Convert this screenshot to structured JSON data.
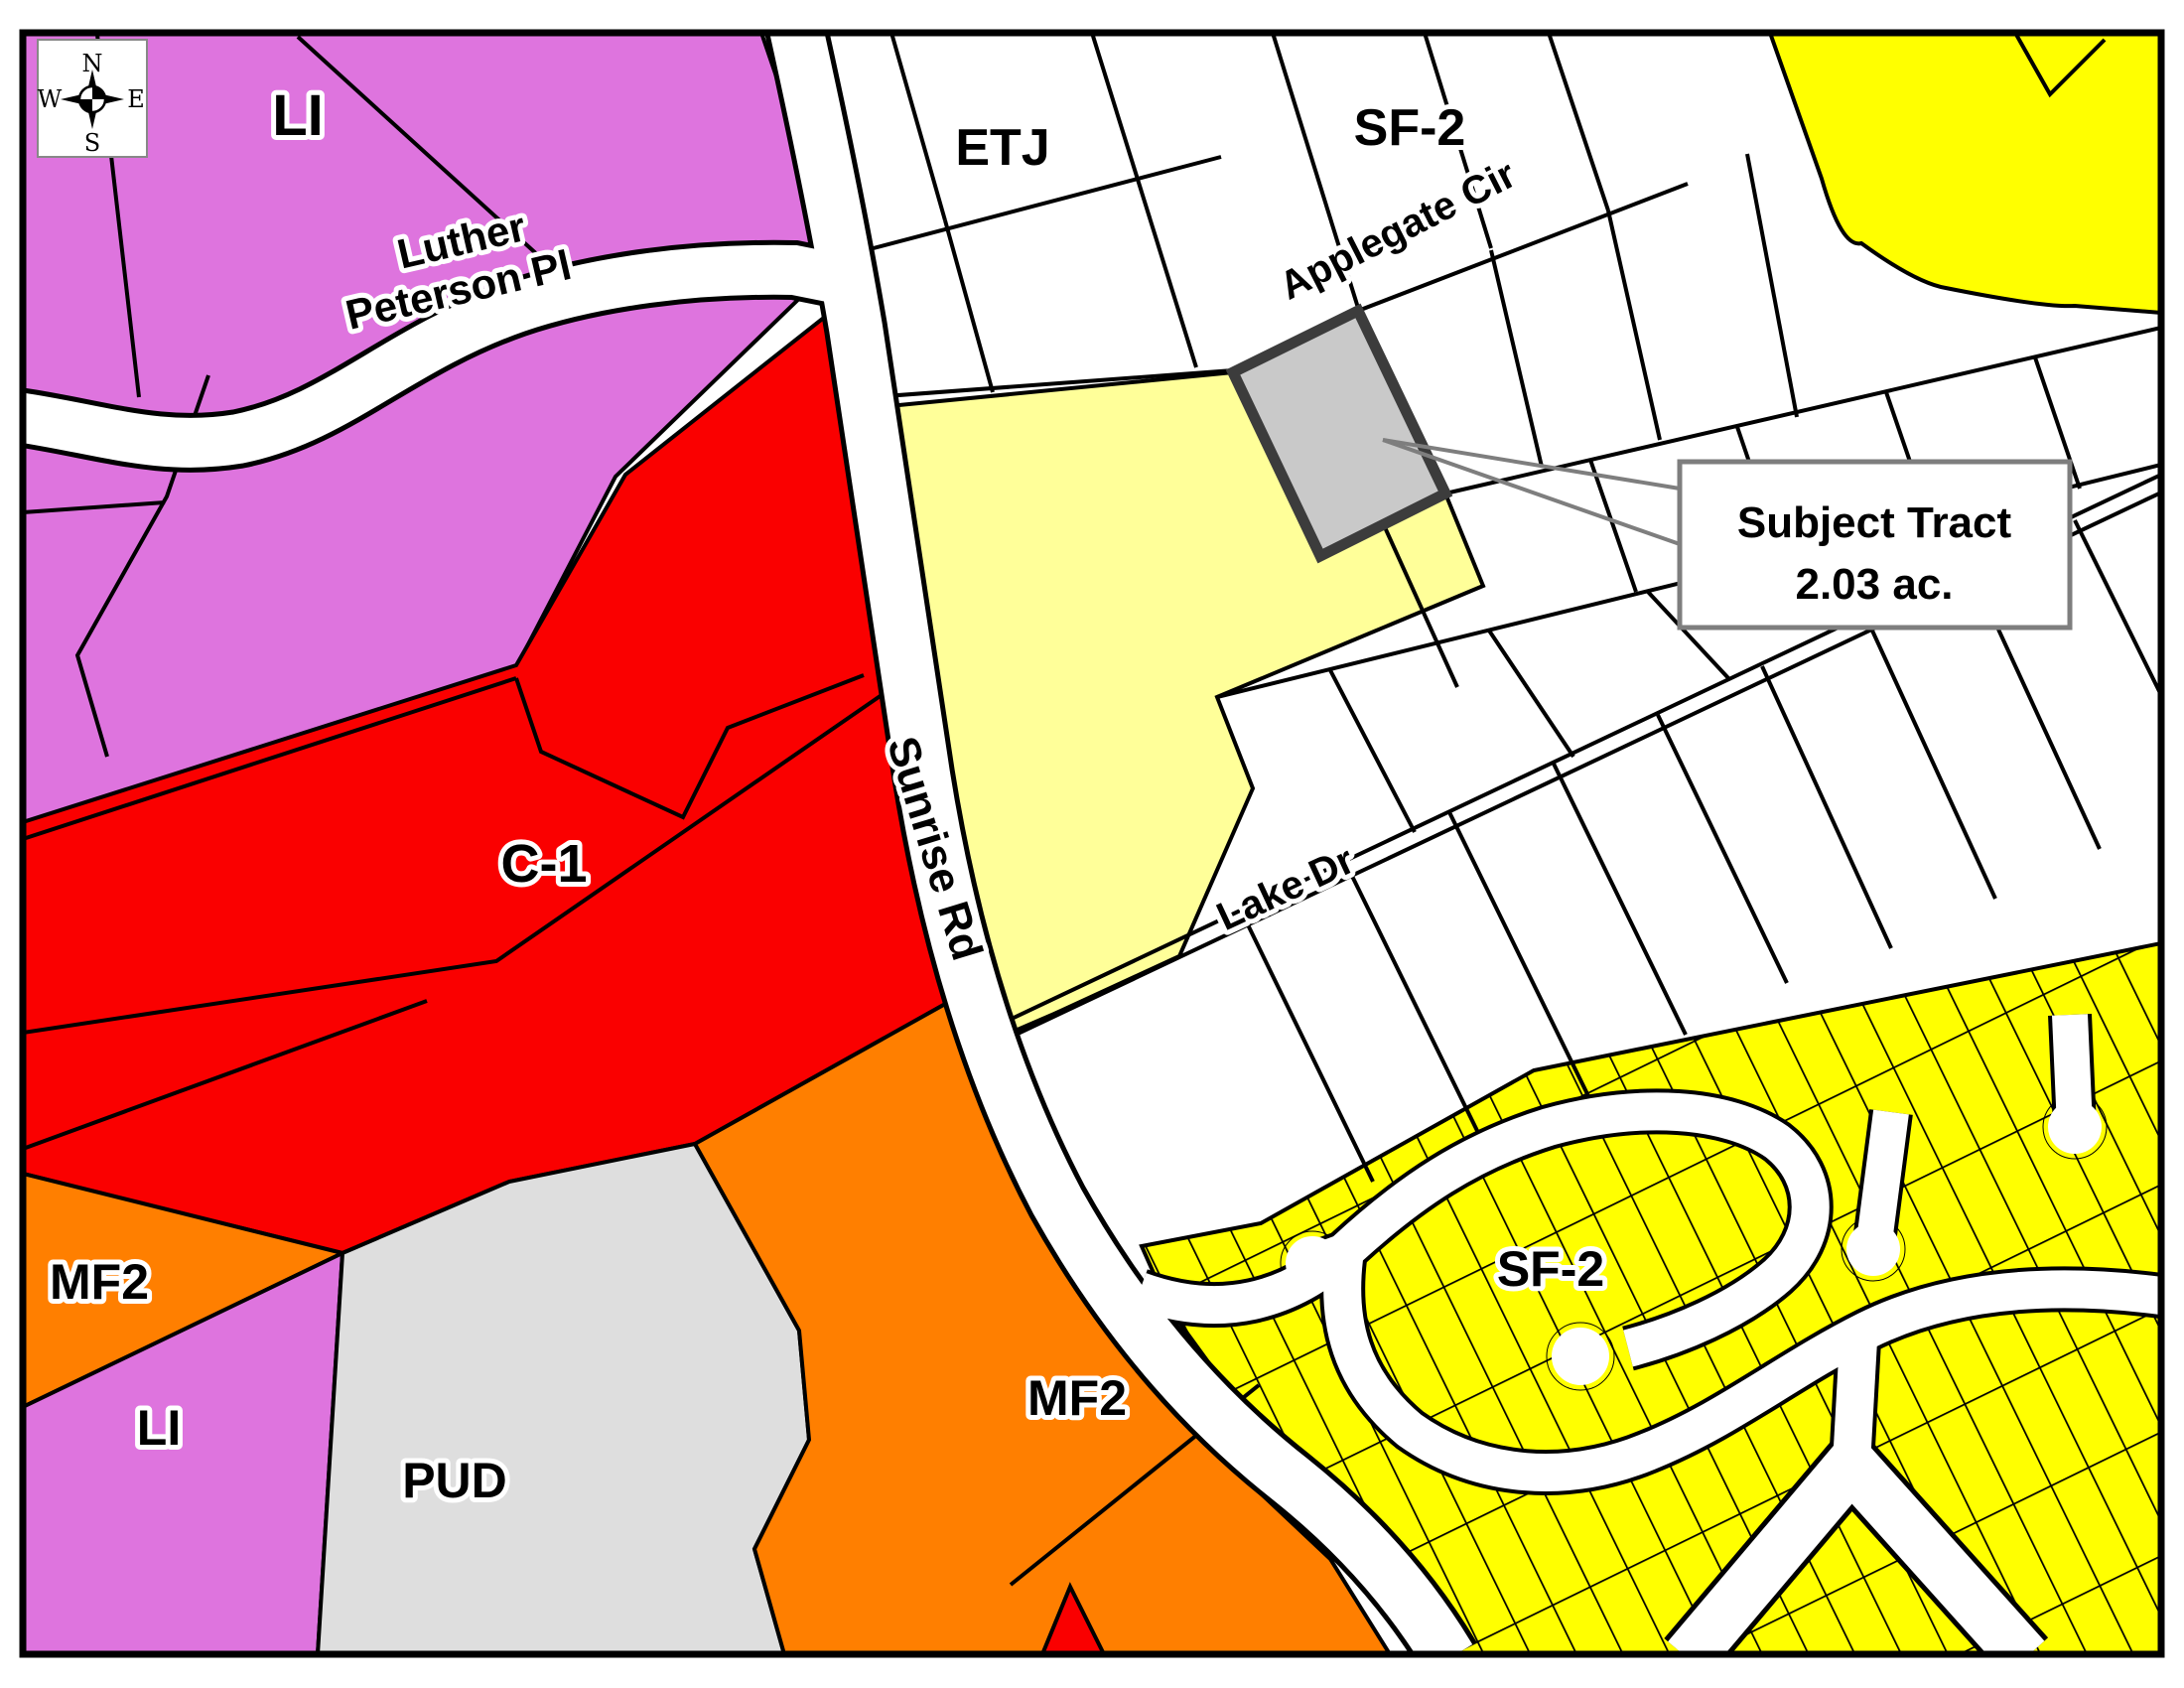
{
  "map": {
    "title": "Zoning map with subject tract",
    "zone_labels": {
      "li_top": {
        "text": "LI"
      },
      "etj": {
        "text": "ETJ"
      },
      "sf2_top": {
        "text": "SF-2"
      },
      "c1": {
        "text": "C-1"
      },
      "mf2_left": {
        "text": "MF2"
      },
      "li_bottom": {
        "text": "LI"
      },
      "pud": {
        "text": "PUD"
      },
      "mf2_main": {
        "text": "MF2"
      },
      "sf2_main": {
        "text": "SF-2"
      }
    },
    "street_labels": {
      "luther_line1": "Luther",
      "luther_line2": "Peterson Pl",
      "sunrise": "Sunrise Rd",
      "applegate": "Applegate Cir",
      "lake": "Lake Dr"
    },
    "callout": {
      "line1": "Subject Tract",
      "line2": "2.03 ac."
    },
    "compass": {
      "north": "N",
      "south": "S",
      "east": "E",
      "west": "W"
    },
    "colors": {
      "li": "#DE74DE",
      "c1": "#FA0000",
      "mf2": "#FF7F00",
      "sf2": "#FFFF00",
      "parcel_highlight": "#FFFF99",
      "subject_tract_fill": "#C9C9C9",
      "subject_tract_border": "#3C3C3C",
      "pud": "#DEDEDE",
      "road": "#FFFFFF",
      "line": "#000000",
      "callout_border": "#7E7E7E",
      "background": "#FFFFFF"
    }
  }
}
